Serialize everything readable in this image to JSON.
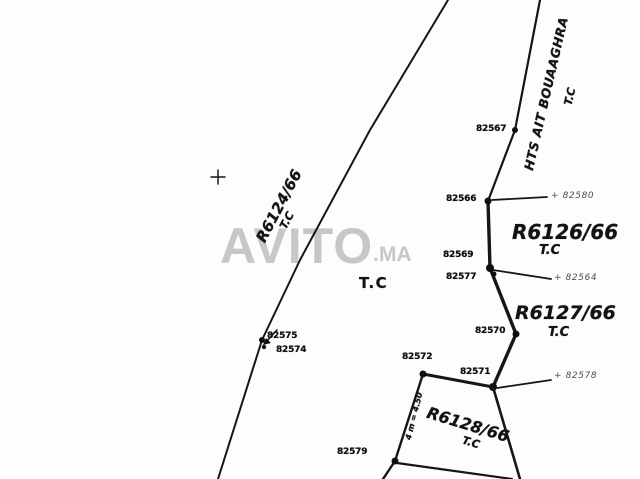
{
  "watermark": {
    "brand": "AVITO",
    "tld": ".MA"
  },
  "road": {
    "name": "HTS AIT BOUAAGHRA",
    "tenure": "T.C"
  },
  "parcels": {
    "r6124": {
      "id": "R6124/66",
      "tenure": "T.C"
    },
    "r6126": {
      "id": "R6126/66",
      "tenure": "T.C"
    },
    "r6127": {
      "id": "R6127/66",
      "tenure": "T.C"
    },
    "r6128": {
      "id": "R6128/66",
      "tenure": "T.C"
    }
  },
  "area_tc": "T.C",
  "points": {
    "p82567": "82567",
    "p82566": "82566",
    "p82569": "82569",
    "p82577": "82577",
    "p82570": "82570",
    "p82571": "82571",
    "p82572": "82572",
    "p82575": "82575",
    "p82574": "82574",
    "p82579": "82579"
  },
  "refs": {
    "p82580": "+ 82580",
    "p82564": "+ 82564",
    "p82578": "+ 82578"
  },
  "annotation": "4 m = 4.50",
  "colors": {
    "ink": "#161616",
    "watermark": "#c7c7c7",
    "ref_ink": "#4f4f4f",
    "background": "#ffffff"
  }
}
